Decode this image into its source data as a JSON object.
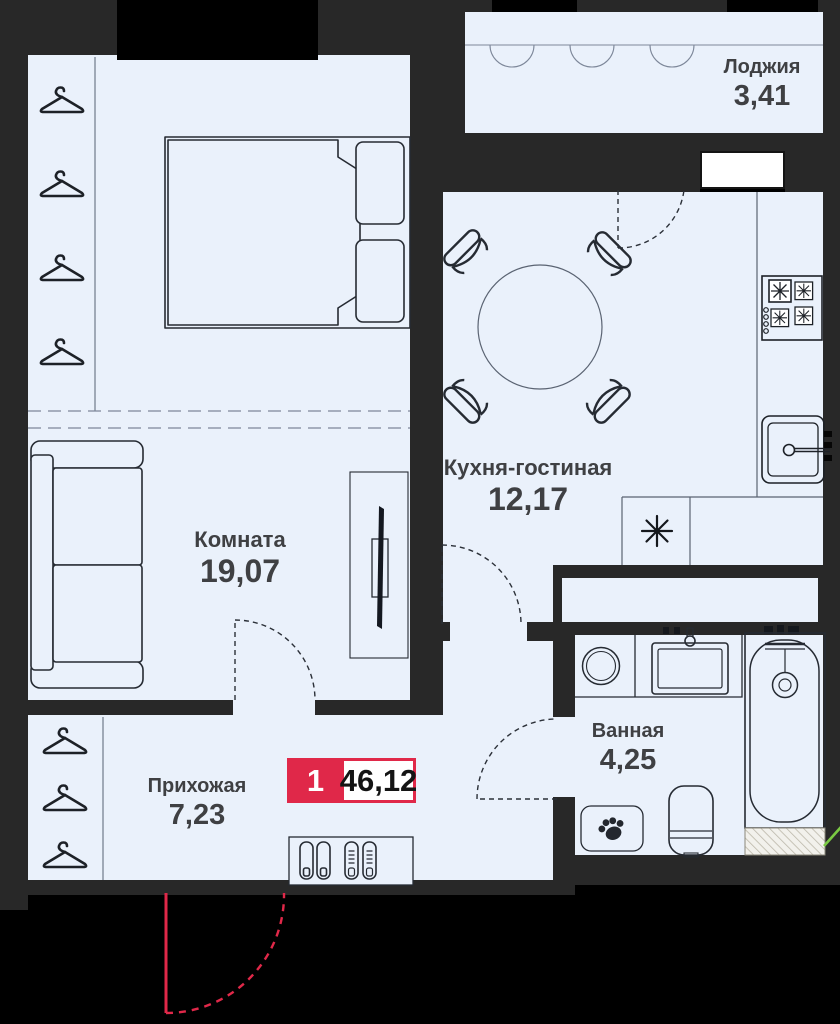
{
  "plan": {
    "type": "apartment-floor-plan",
    "rooms": [
      {
        "name": "Комната",
        "area": "19,07"
      },
      {
        "name": "Кухня-гостиная",
        "area": "12,17"
      },
      {
        "name": "Прихожая",
        "area": "7,23"
      },
      {
        "name": "Ванная",
        "area": "4,25"
      },
      {
        "name": "Лоджия",
        "area": "3,41"
      }
    ],
    "badge": {
      "rooms_count": "1",
      "total_area": "46,12"
    }
  },
  "icons": {
    "hanger": "hanger-icon",
    "snowflake": "snowflake-icon (fridge place)",
    "paw": "paw-print-mat-icon",
    "shoes": "shoe-rack-icon"
  },
  "colors": {
    "accent_red": "#e02849",
    "floor": "#eaf1fb",
    "wall": "#282828",
    "background": "#000000",
    "line_dark": "#262b33",
    "line_light": "#7d8799",
    "text": "#3f4043",
    "green_mark": "#7ac943"
  }
}
